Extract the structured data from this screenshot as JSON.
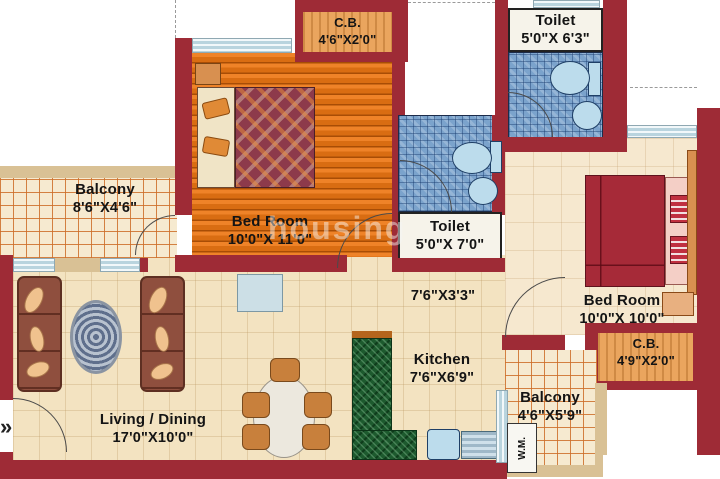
{
  "plan": {
    "watermark": "housing",
    "entrance_arrow": "»",
    "rooms": {
      "cb_top": {
        "name": "C.B.",
        "dims": "4'6\"X2'0\""
      },
      "toilet_top": {
        "name": "Toilet",
        "dims": "5'0\"X 6'3\""
      },
      "balcony_left": {
        "name": "Balcony",
        "dims": "8'6\"X4'6\""
      },
      "bedroom_left": {
        "name": "Bed Room",
        "dims": "10'0\"X 11'0\""
      },
      "toilet_mid": {
        "name": "Toilet",
        "dims": "5'0\"X 7'0\""
      },
      "passage": {
        "dims": "7'6\"X3'3\""
      },
      "bedroom_right": {
        "name": "Bed Room",
        "dims": "10'0\"X 10'0\""
      },
      "cb_right": {
        "name": "C.B.",
        "dims": "4'9\"X2'0\""
      },
      "kitchen": {
        "name": "Kitchen",
        "dims": "7'6\"X6'9\""
      },
      "balcony_right": {
        "name": "Balcony",
        "dims": "4'6\"X5'9\""
      },
      "living": {
        "name": "Living / Dining",
        "dims": "17'0\"X10'0\""
      },
      "wm": {
        "name": "W.M."
      }
    },
    "colors": {
      "wall": "#9e2b36",
      "floor": "#f3e3c1",
      "wood_floor": "#e5761c",
      "tile_line": "#d4732a",
      "mosaic": "#7ba3cc",
      "granite": "#1d5a2e",
      "fixture": "#bcdcec",
      "window": "#cfe2ea",
      "parapet": "#d9c195"
    }
  }
}
